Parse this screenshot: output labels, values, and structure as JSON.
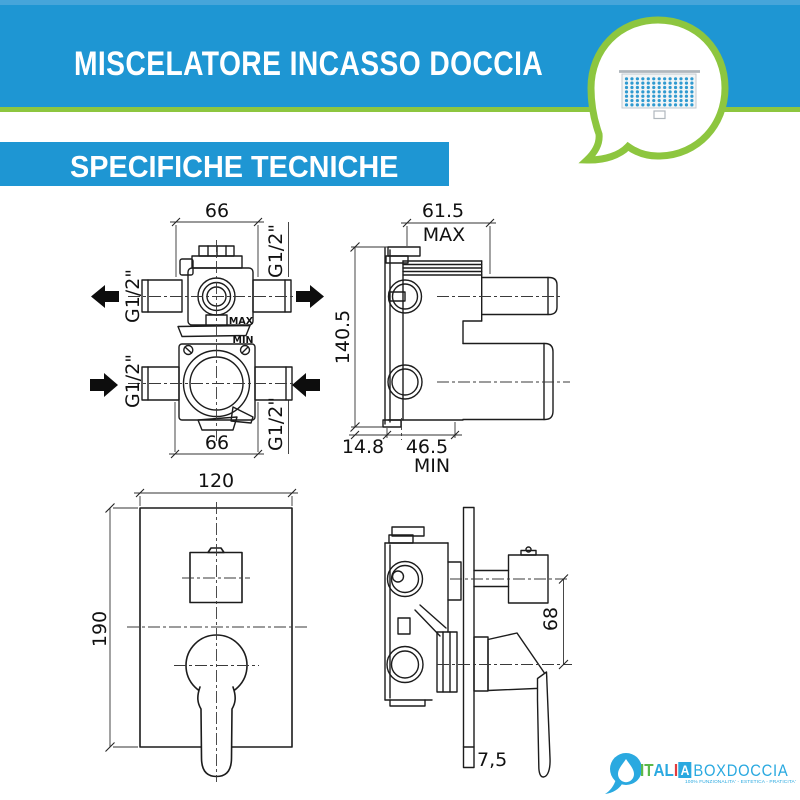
{
  "colors": {
    "banner_blue": "#1e96d3",
    "accent_green": "#8dc63f",
    "logo_blue": "#2aa9e0",
    "logo_green": "#5cb849",
    "logo_red": "#e23b3e"
  },
  "header": {
    "title": "MISCELATORE INCASSO DOCCIA",
    "subtitle": "SPECIFICHE TECNICHE"
  },
  "bubble_icon": {
    "name": "shower-head",
    "rows": 7,
    "cols": 13
  },
  "drawings": {
    "front_valve": {
      "dim_top": "66",
      "dim_bottom": "66",
      "thread": "G1/2\"",
      "max_label": "MAX",
      "min_label": "MIN"
    },
    "side_valve": {
      "dim_width": "61.5",
      "width_label": "MAX",
      "dim_height": "140.5",
      "dim_wall_offset": "14.8",
      "dim_depth": "46.5",
      "depth_label": "MIN"
    },
    "front_plate": {
      "dim_width": "120",
      "dim_height": "190"
    },
    "side_mounted": {
      "dim_centers": "68",
      "dim_plate_thickness": "7,5"
    }
  },
  "logo": {
    "italia_it": "IT",
    "italia_al": "AL",
    "italia_i": "I",
    "italia_a": "A",
    "boxdoccia": "BOXDOCCIA",
    "tagline": "100% FUNZIONALITA' - ESTETICA - PRATICITA'"
  }
}
